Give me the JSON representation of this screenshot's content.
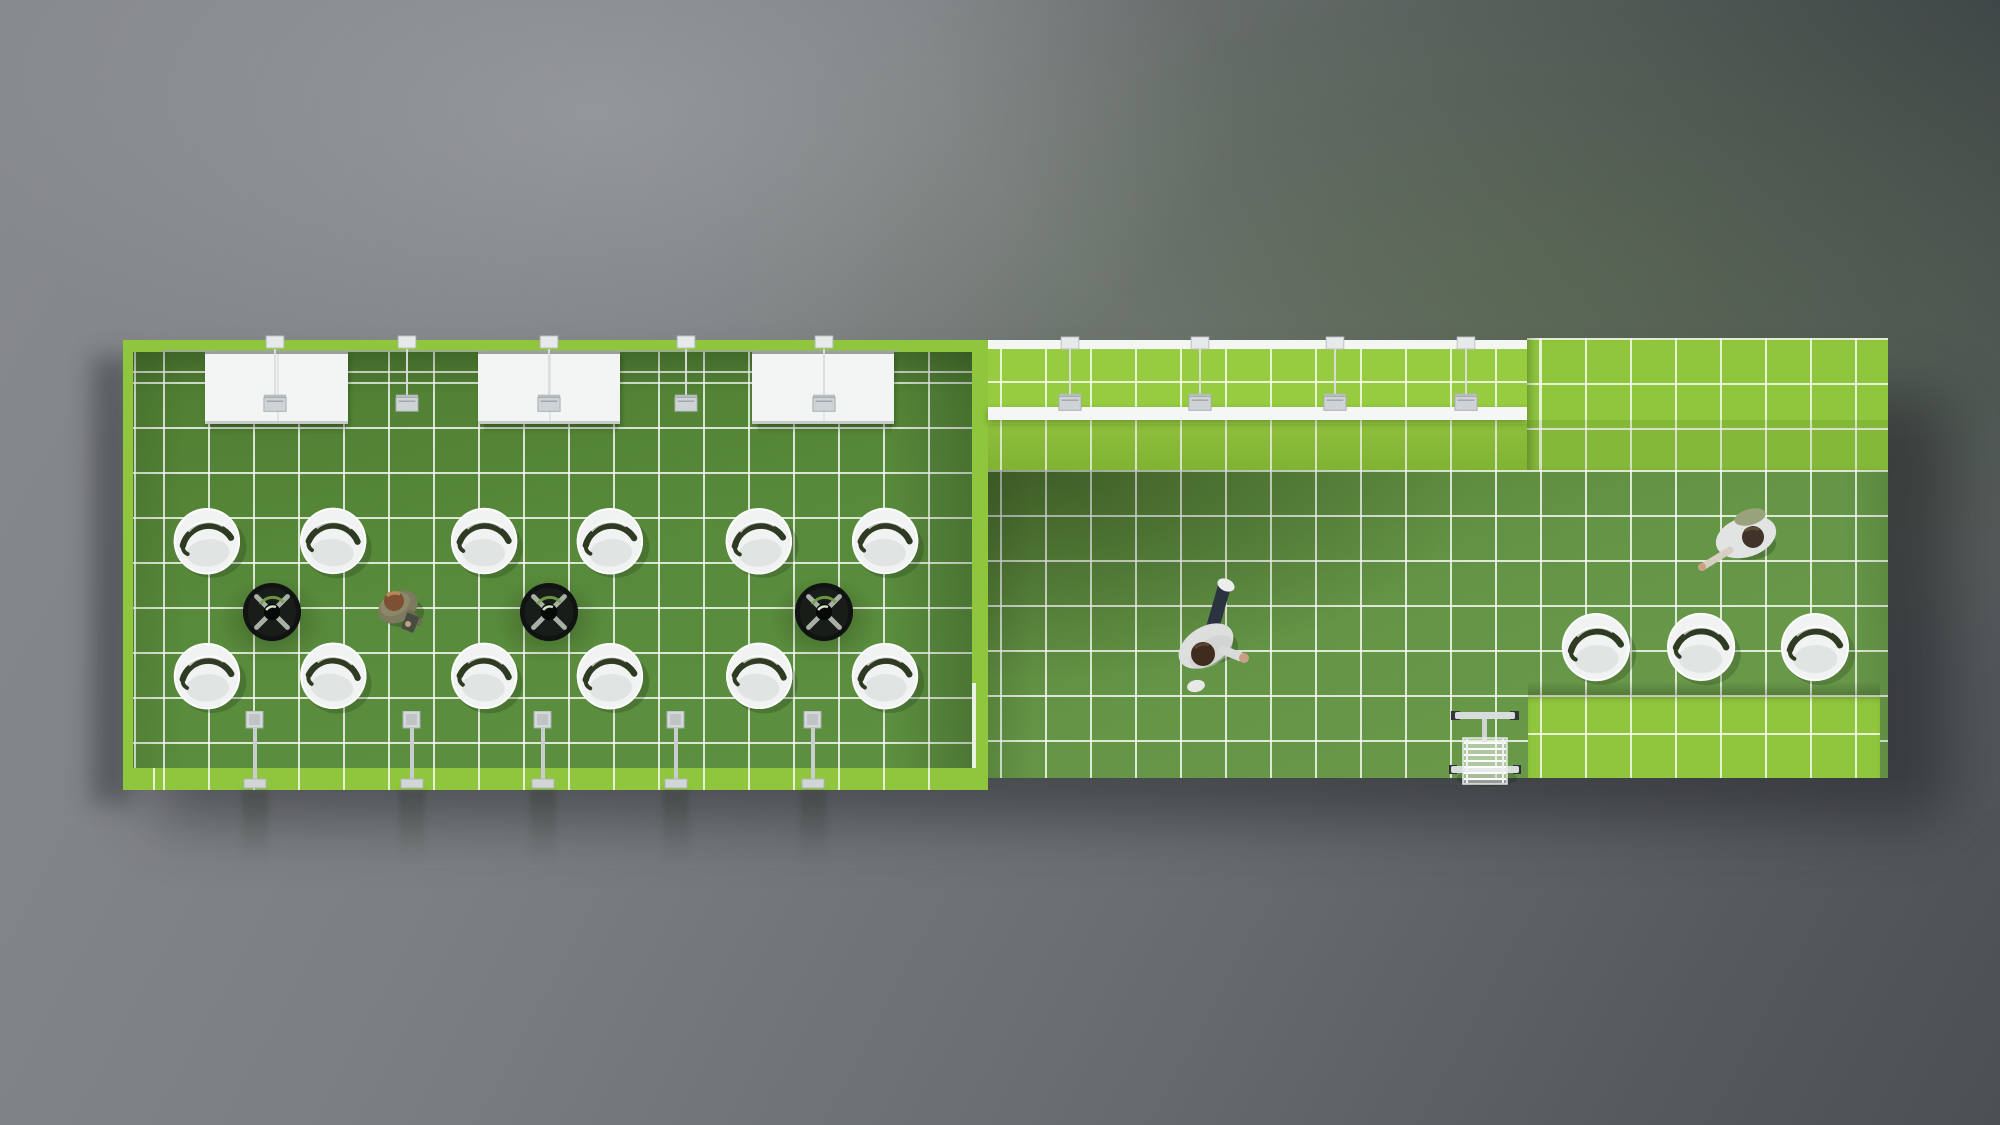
{
  "scene": {
    "title": "top-down-render-green-exhibition-stand",
    "palette": {
      "bright_green": "#8fc63d",
      "band_green": "#97cb40",
      "left_carpet": "#57893a",
      "right_floor": "#649546",
      "grid_line": "rgba(255,255,255,0.78)",
      "white_surface": "#f3f5f4",
      "metal_gray": "#ced3d5",
      "table_black": "#101312",
      "chair_white": "#f1f3f2",
      "chair_slot": "#2e3a21",
      "backdrop_gray": "#74787c"
    },
    "left_room": {
      "cabinets": [
        {
          "x": 205,
          "y": 352,
          "w": 143,
          "h": 67
        },
        {
          "x": 478,
          "y": 352,
          "w": 142,
          "h": 67
        },
        {
          "x": 752,
          "y": 352,
          "w": 142,
          "h": 67
        }
      ],
      "ceiling_mounts_x": [
        275,
        407,
        549,
        686,
        824
      ],
      "pendant_lamps_x": [
        275,
        407,
        549,
        686,
        824
      ],
      "pendant_drop": {
        "y1": 349,
        "y2": 395
      },
      "floor_fixtures_x": [
        255,
        412,
        543,
        676,
        813
      ],
      "floor_fixtures_y": 711,
      "seating_groups": [
        {
          "x": 272,
          "chair_dx": 63,
          "top_y": 543,
          "bottom_y": 678,
          "table_y": 612
        },
        {
          "x": 549,
          "chair_dx": 63,
          "top_y": 543,
          "bottom_y": 678,
          "table_y": 612
        },
        {
          "x": 824,
          "chair_dx": 63,
          "top_y": 543,
          "bottom_y": 678,
          "table_y": 612
        }
      ],
      "chair_rotations": [
        -6,
        4,
        -3,
        7,
        2,
        -5,
        5,
        -4,
        -7,
        3,
        6,
        -2
      ]
    },
    "right_room": {
      "ceiling_mounts_x": [
        1070,
        1200,
        1335,
        1466
      ],
      "pendant_lamps_x": [
        1070,
        1200,
        1335,
        1466
      ],
      "pendant_drop": {
        "y1": 349,
        "y2": 394
      },
      "chairs": [
        {
          "x": 1598,
          "y": 649,
          "rot": -4
        },
        {
          "x": 1703,
          "y": 649,
          "rot": 3
        },
        {
          "x": 1817,
          "y": 649,
          "rot": -2
        }
      ],
      "cart": {
        "x": 1485,
        "y": 747
      }
    },
    "people": [
      {
        "kind": "visitor-with-tablet",
        "x": 399,
        "y": 605
      },
      {
        "kind": "visitor-walking",
        "x": 1209,
        "y": 636
      },
      {
        "kind": "visitor-standing",
        "x": 1745,
        "y": 540
      }
    ]
  }
}
